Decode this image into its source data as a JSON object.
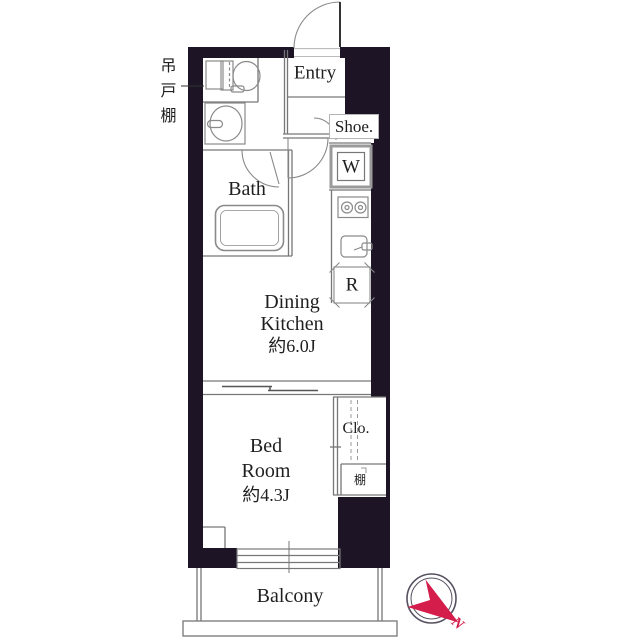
{
  "colors": {
    "wall": "#1d1426",
    "partition": "#777777",
    "text": "#1f1f1f",
    "compass_red": "#d41d4b"
  },
  "labels": {
    "hanging_cupboard": "吊戸棚",
    "entry": "Entry",
    "shoe_cabinet": "Shoe.",
    "washing_machine": "W",
    "refrigerator": "R",
    "bath": "Bath",
    "dining_kitchen_line1": "Dining",
    "dining_kitchen_line2": "Kitchen",
    "dining_kitchen_size": "約6.0J",
    "bed_room_line1": "Bed",
    "bed_room_line2": "Room",
    "bed_room_size": "約4.3J",
    "closet": "Clo.",
    "shelf": "棚",
    "balcony": "Balcony",
    "compass_north": "N"
  }
}
